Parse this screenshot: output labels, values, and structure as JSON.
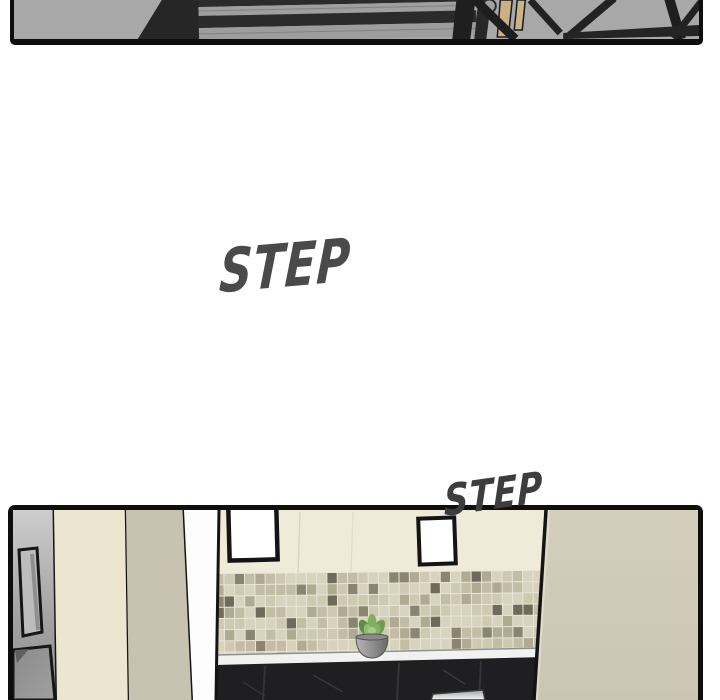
{
  "page": {
    "type": "webtoon-comic-strip",
    "background": "#ffffff"
  },
  "panels": {
    "staircase": {
      "name": "staircase-overhead-panel"
    },
    "kitchen": {
      "name": "kitchen-interior-panel"
    }
  },
  "sfx": {
    "step_large": {
      "text": "STEP",
      "color": "#4a4a4a"
    },
    "step_small": {
      "text": "STEP",
      "color": "#3d3d3d"
    }
  },
  "palette": {
    "panel_border": "#0e0e0e",
    "stair_gray": "#a8a8a8",
    "stair_dark": "#2b2b2b",
    "railing_tan": "#c8b184",
    "wall_cream": "#f0ead9",
    "pillar_cream": "#ece5d0",
    "pillar_tan": "#c8c2b1",
    "fridge_gray": "#adadad",
    "door_tan": "#d1cbba",
    "counter_white": "#f1f2f0",
    "cabinet_black": "#1f1f21",
    "tile_grout": "#e9e5d6",
    "tile_colors": [
      "#d8d3be",
      "#cfc9b2",
      "#c3bda6",
      "#b1aa92",
      "#8b8471",
      "#6f6a5a"
    ],
    "plant_green": "#6f9c4e",
    "pot_gray": "#8f8f8f"
  }
}
